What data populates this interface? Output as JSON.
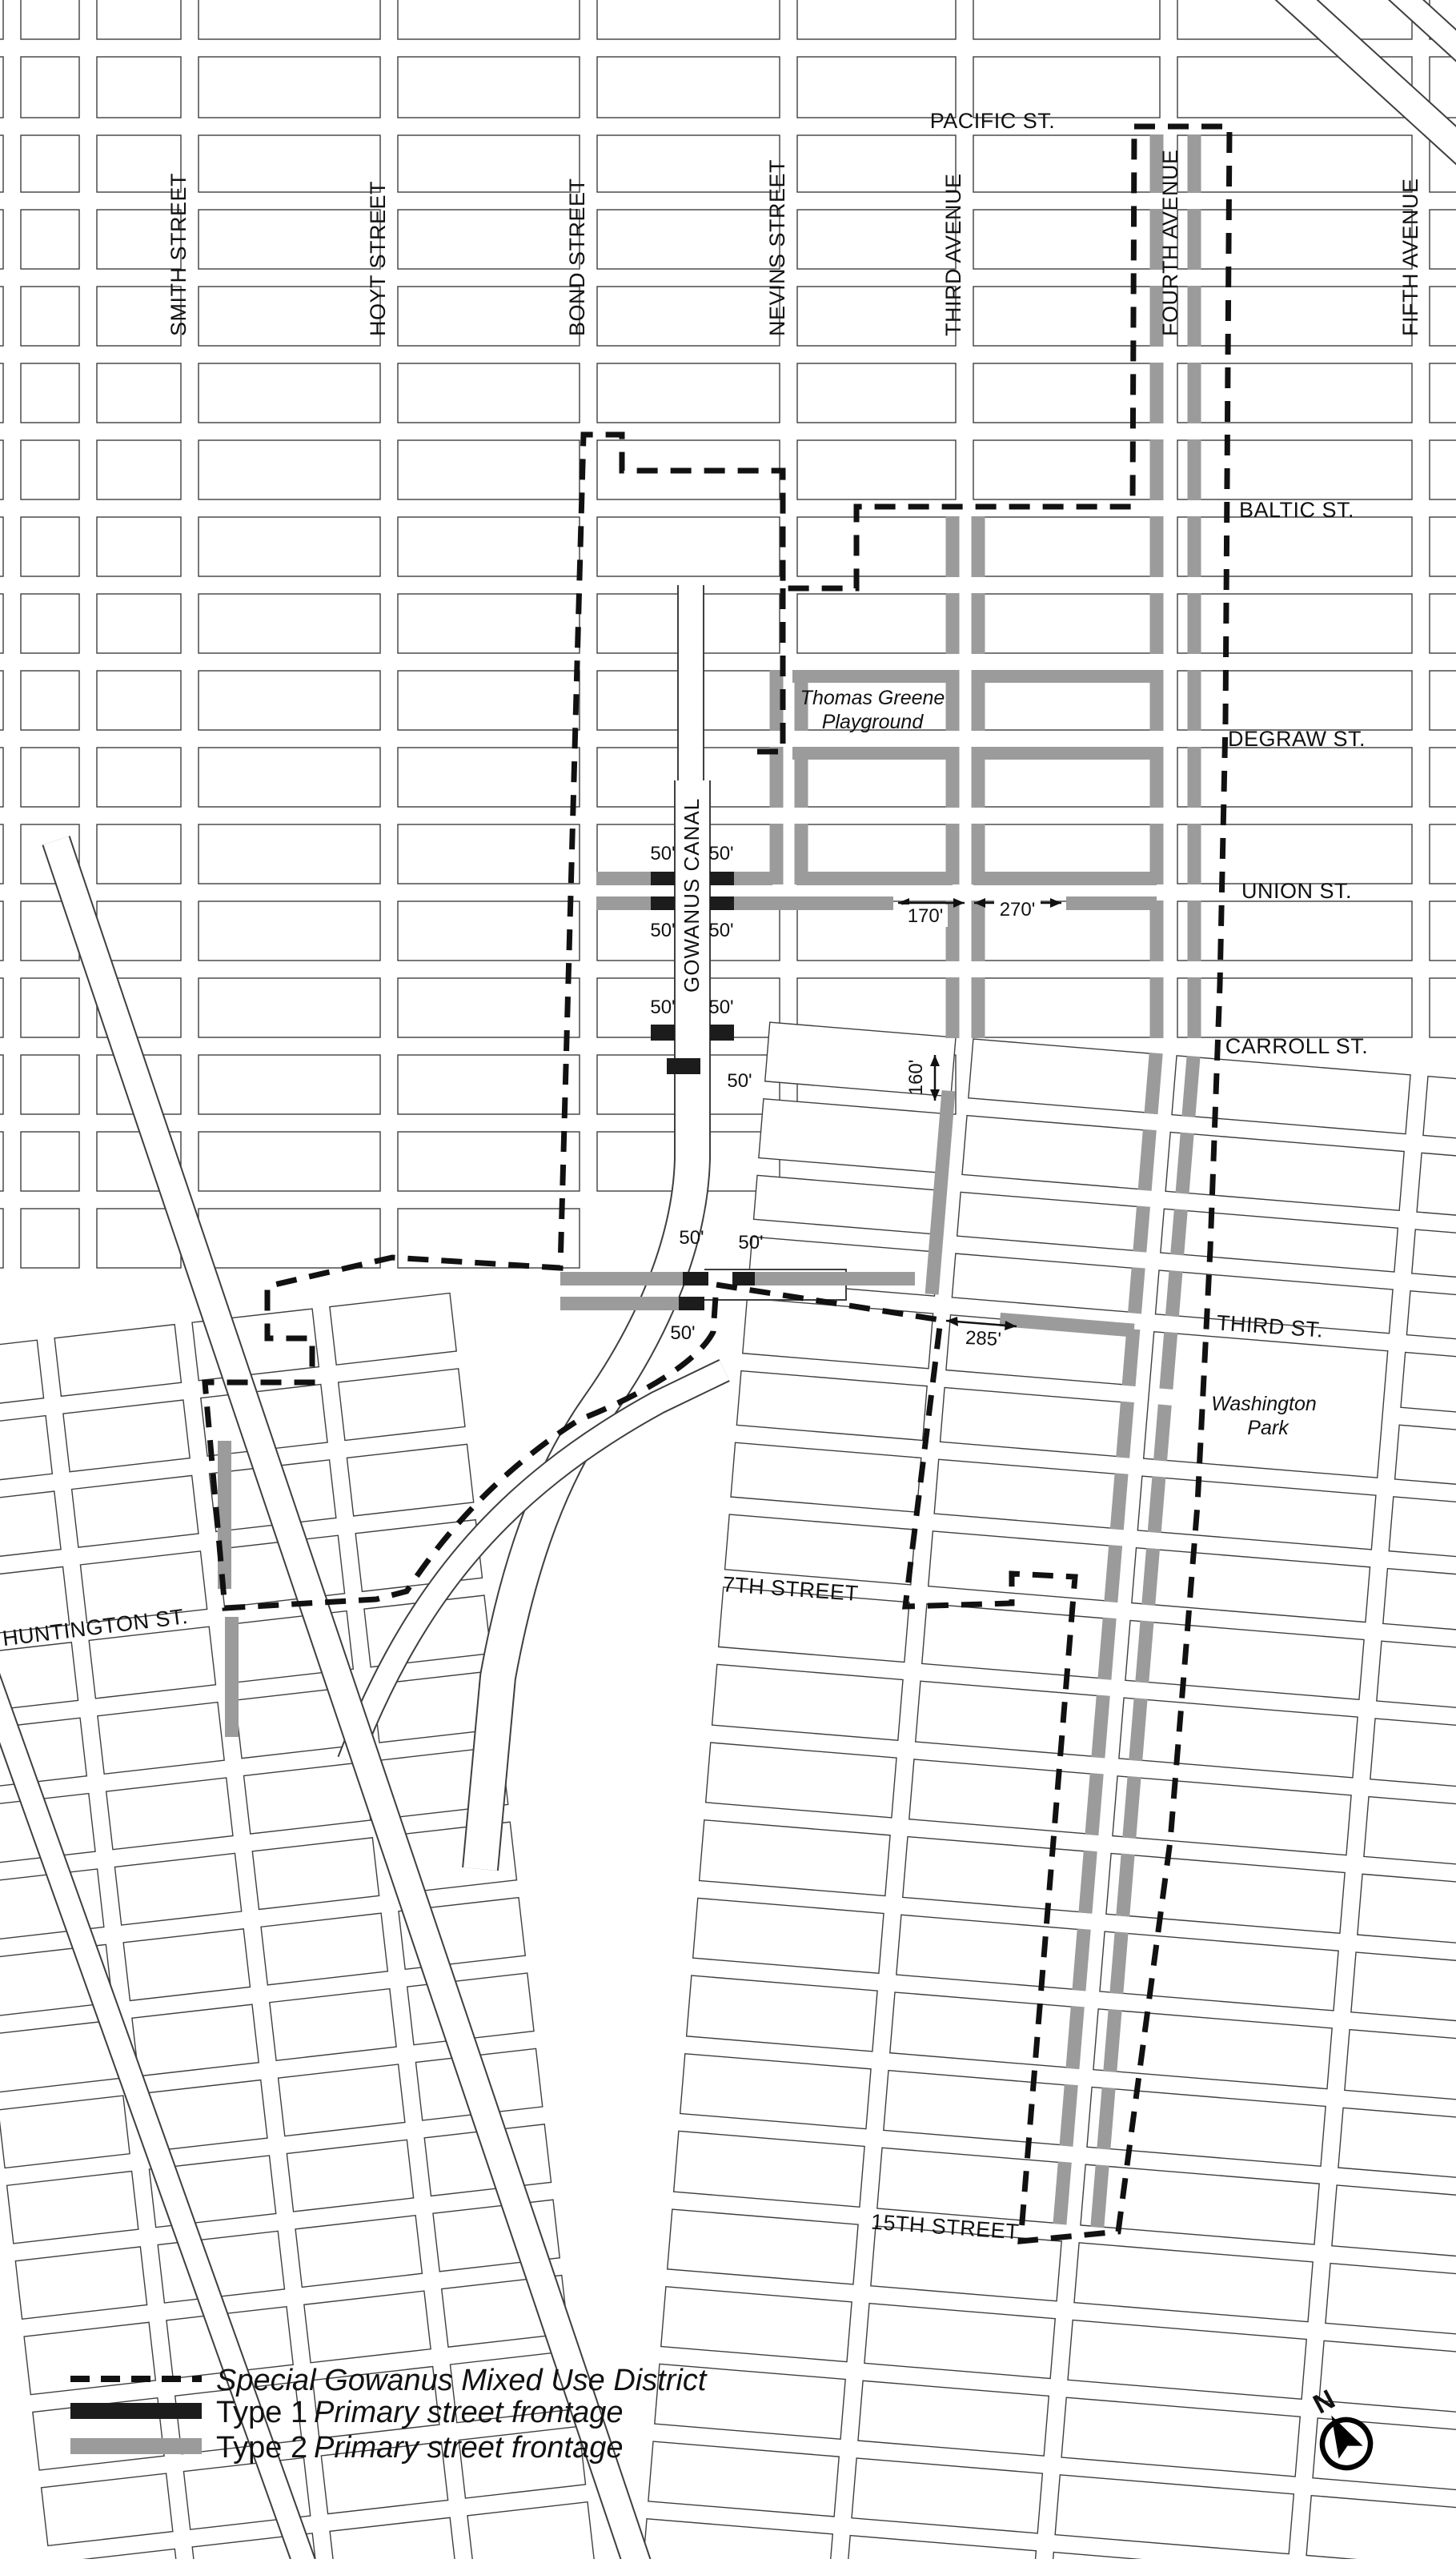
{
  "map": {
    "avenue_labels": [
      "SMITH STREET",
      "HOYT STREET",
      "BOND STREET",
      "NEVINS STREET",
      "THIRD AVENUE",
      "FOURTH AVENUE",
      "FIFTH AVENUE"
    ],
    "cross_street_labels": [
      "PACIFIC ST.",
      "BALTIC ST.",
      "DEGRAW ST.",
      "UNION ST.",
      "CARROLL ST.",
      "THIRD ST.",
      "7TH STREET",
      "HUNTINGTON ST.",
      "15TH STREET"
    ],
    "feature_labels": {
      "canal": "GOWANUS CANAL",
      "playground_line1": "Thomas Greene",
      "playground_line2": "Playground",
      "park_line1": "Washington",
      "park_line2": "Park"
    },
    "dimension_labels": [
      "50'",
      "50'",
      "50'",
      "50'",
      "50'",
      "50'",
      "50'",
      "50'",
      "50'",
      "50'",
      "170'",
      "270'",
      "160'",
      "285'"
    ]
  },
  "legend": {
    "items": [
      {
        "prefix": "",
        "label": "Special Gowanus Mixed Use District",
        "style": "district-boundary"
      },
      {
        "prefix": "Type 1",
        "label": "Primary street frontage",
        "style": "type1"
      },
      {
        "prefix": "Type 2",
        "label": "Primary street frontage",
        "style": "type2"
      }
    ]
  },
  "compass": {
    "north_label": "N"
  },
  "colors": {
    "type1": "#1c1c1c",
    "type2": "#9b9b9b",
    "boundary": "#111111",
    "street_line": "#3f3f3f"
  }
}
